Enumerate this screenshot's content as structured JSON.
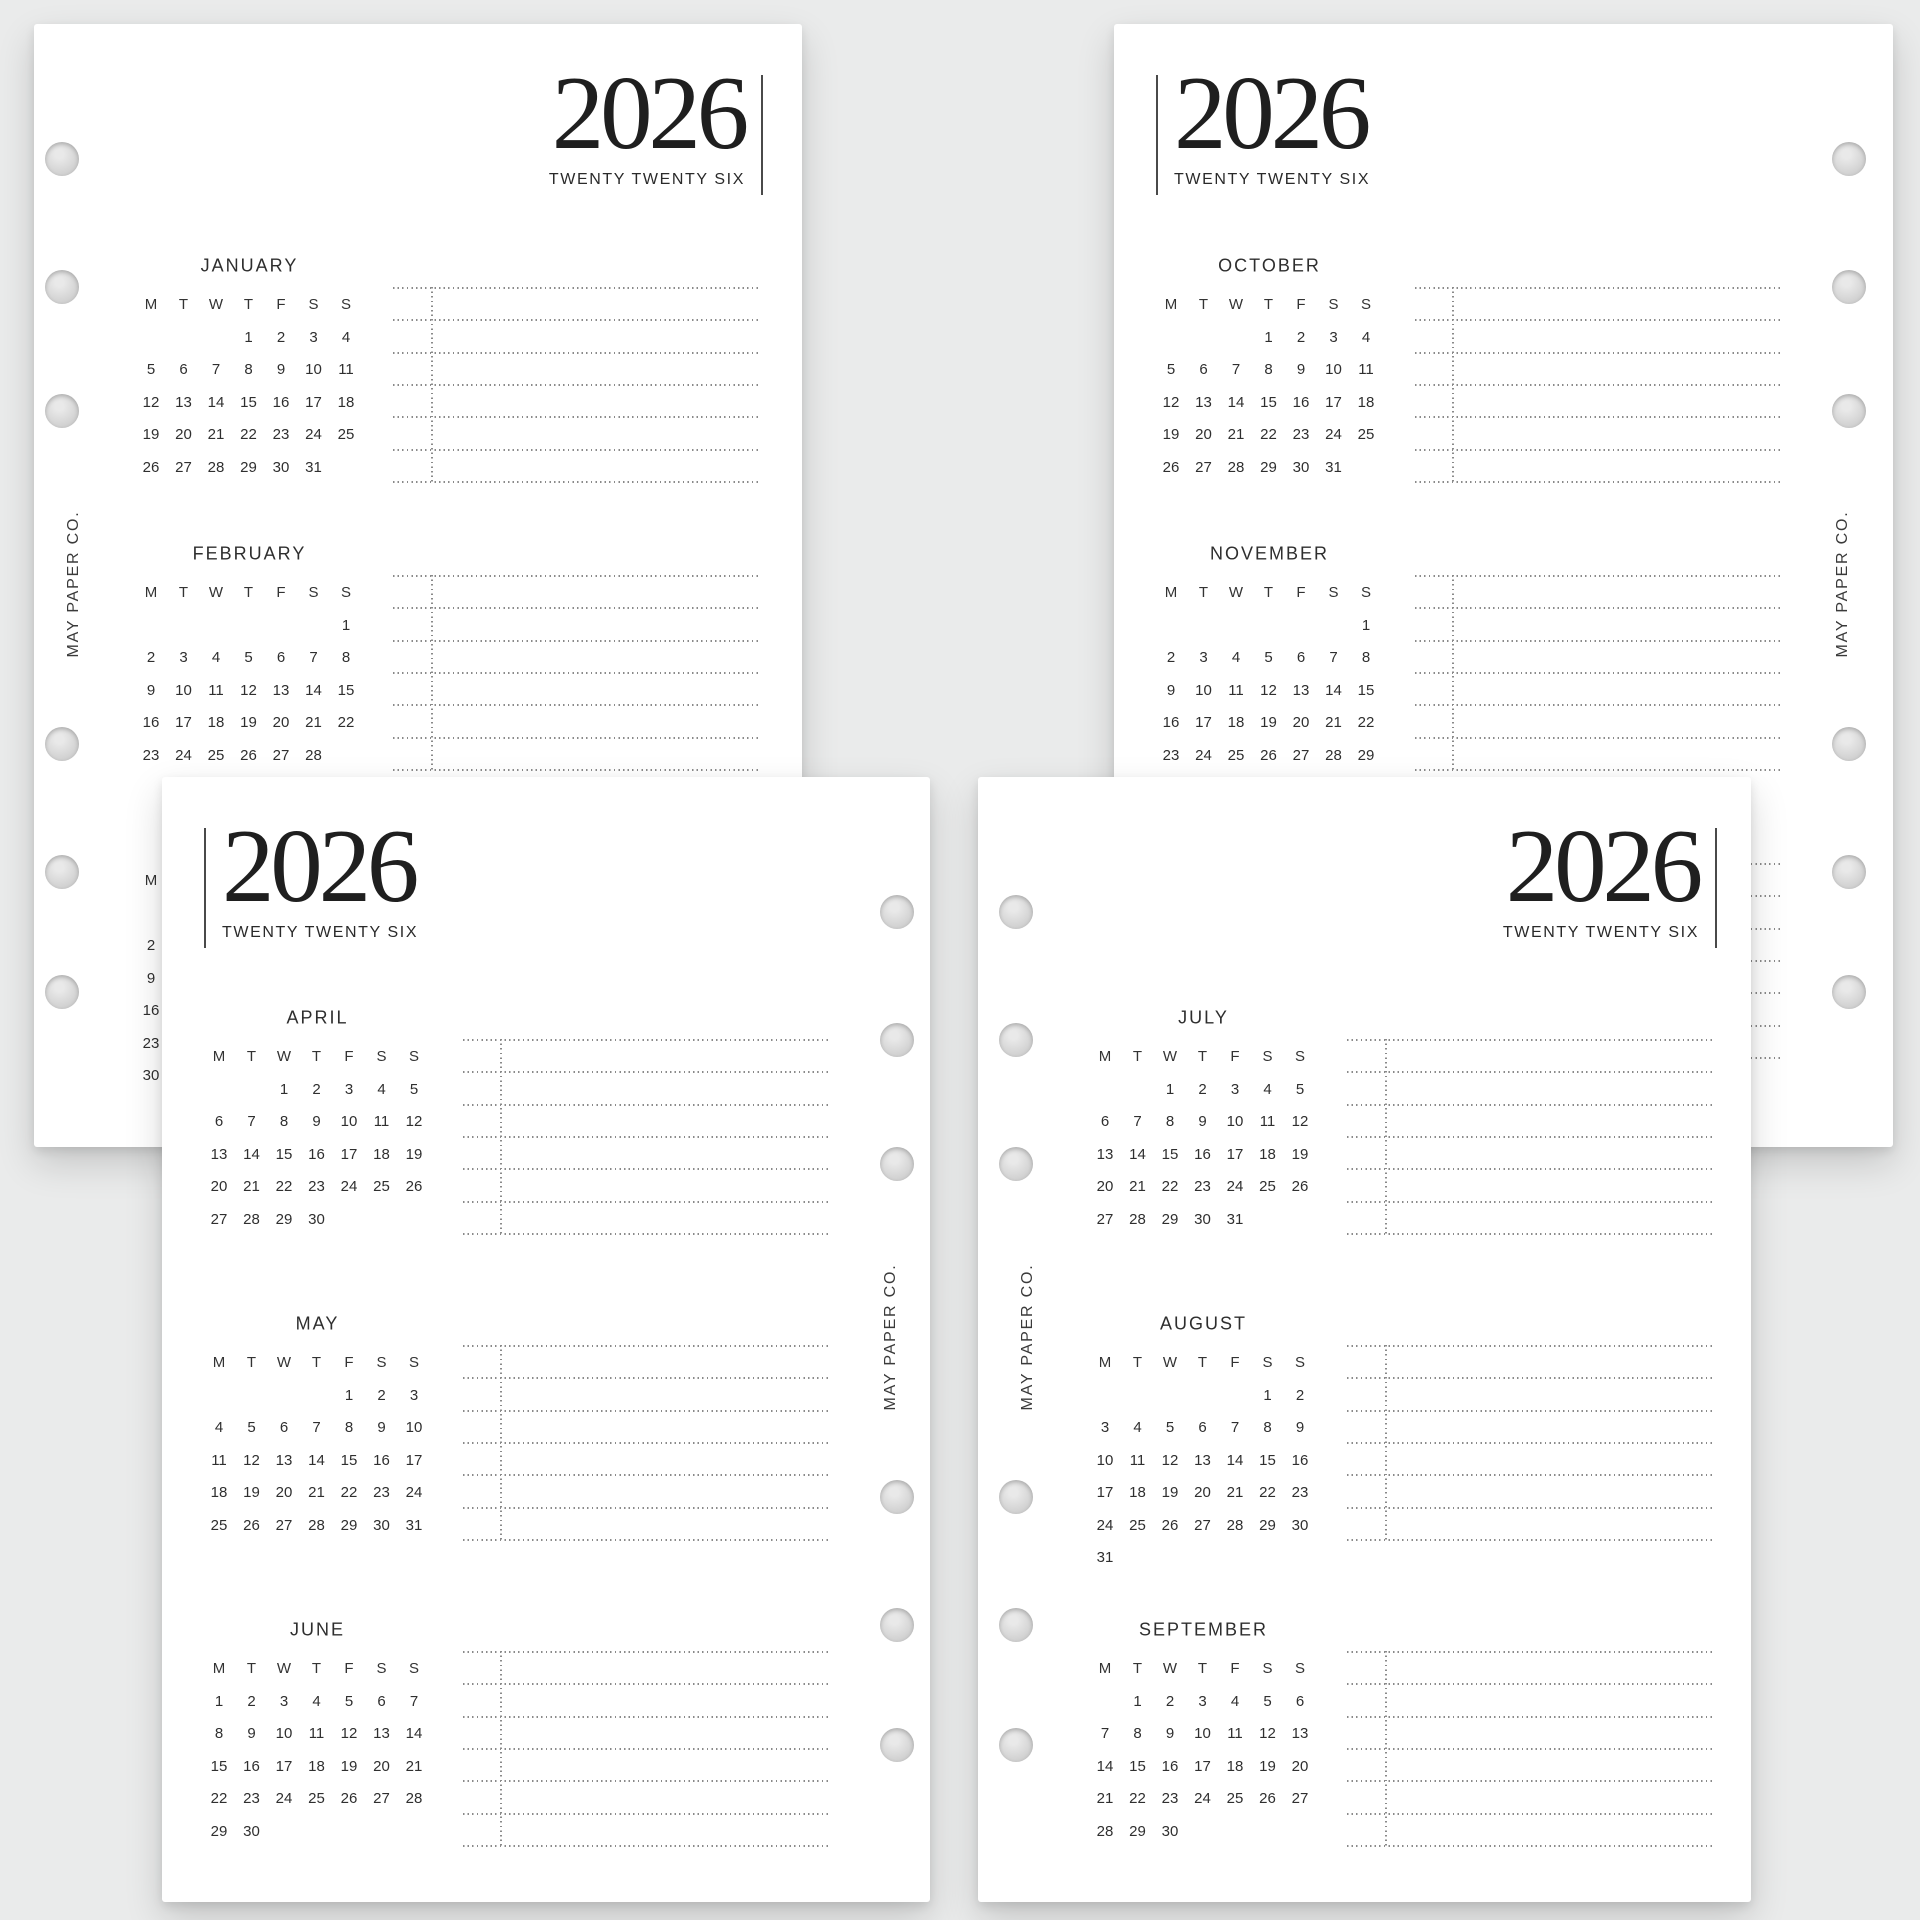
{
  "canvas": {
    "background": "#eaebeb"
  },
  "brand": {
    "label": "MAY PAPER CO."
  },
  "header": {
    "year": "2026",
    "subtitle": "TWENTY TWENTY SIX"
  },
  "weekdays": [
    "M",
    "T",
    "W",
    "T",
    "F",
    "S",
    "S"
  ],
  "colors": {
    "page": "#ffffff",
    "text": "#2e2e2e",
    "year_text": "#1f1f1f",
    "dotted_line": "#8a8a8a",
    "divider_bar": "#4a4a4a",
    "hole_fill": "#d6d6d6"
  },
  "months": {
    "JANUARY": {
      "name": "JANUARY",
      "weeks": [
        [
          "",
          "",
          "",
          "1",
          "2",
          "3",
          "4"
        ],
        [
          "5",
          "6",
          "7",
          "8",
          "9",
          "10",
          "11"
        ],
        [
          "12",
          "13",
          "14",
          "15",
          "16",
          "17",
          "18"
        ],
        [
          "19",
          "20",
          "21",
          "22",
          "23",
          "24",
          "25"
        ],
        [
          "26",
          "27",
          "28",
          "29",
          "30",
          "31",
          ""
        ]
      ]
    },
    "FEBRUARY": {
      "name": "FEBRUARY",
      "weeks": [
        [
          "",
          "",
          "",
          "",
          "",
          "",
          "1"
        ],
        [
          "2",
          "3",
          "4",
          "5",
          "6",
          "7",
          "8"
        ],
        [
          "9",
          "10",
          "11",
          "12",
          "13",
          "14",
          "15"
        ],
        [
          "16",
          "17",
          "18",
          "19",
          "20",
          "21",
          "22"
        ],
        [
          "23",
          "24",
          "25",
          "26",
          "27",
          "28",
          ""
        ]
      ]
    },
    "MARCH": {
      "name": "MARCH",
      "weeks": [
        [
          "",
          "",
          "",
          "",
          "",
          "",
          "1"
        ],
        [
          "2",
          "3",
          "4",
          "5",
          "6",
          "7",
          "8"
        ],
        [
          "9",
          "10",
          "11",
          "12",
          "13",
          "14",
          "15"
        ],
        [
          "16",
          "17",
          "18",
          "19",
          "20",
          "21",
          "22"
        ],
        [
          "23",
          "24",
          "25",
          "26",
          "27",
          "28",
          "29"
        ],
        [
          "30",
          "31",
          "",
          "",
          "",
          "",
          ""
        ]
      ]
    },
    "APRIL": {
      "name": "APRIL",
      "weeks": [
        [
          "",
          "",
          "1",
          "2",
          "3",
          "4",
          "5"
        ],
        [
          "6",
          "7",
          "8",
          "9",
          "10",
          "11",
          "12"
        ],
        [
          "13",
          "14",
          "15",
          "16",
          "17",
          "18",
          "19"
        ],
        [
          "20",
          "21",
          "22",
          "23",
          "24",
          "25",
          "26"
        ],
        [
          "27",
          "28",
          "29",
          "30",
          "",
          "",
          ""
        ]
      ]
    },
    "MAY": {
      "name": "MAY",
      "weeks": [
        [
          "",
          "",
          "",
          "",
          "1",
          "2",
          "3"
        ],
        [
          "4",
          "5",
          "6",
          "7",
          "8",
          "9",
          "10"
        ],
        [
          "11",
          "12",
          "13",
          "14",
          "15",
          "16",
          "17"
        ],
        [
          "18",
          "19",
          "20",
          "21",
          "22",
          "23",
          "24"
        ],
        [
          "25",
          "26",
          "27",
          "28",
          "29",
          "30",
          "31"
        ]
      ]
    },
    "JUNE": {
      "name": "JUNE",
      "weeks": [
        [
          "1",
          "2",
          "3",
          "4",
          "5",
          "6",
          "7"
        ],
        [
          "8",
          "9",
          "10",
          "11",
          "12",
          "13",
          "14"
        ],
        [
          "15",
          "16",
          "17",
          "18",
          "19",
          "20",
          "21"
        ],
        [
          "22",
          "23",
          "24",
          "25",
          "26",
          "27",
          "28"
        ],
        [
          "29",
          "30",
          "",
          "",
          "",
          "",
          ""
        ]
      ]
    },
    "JULY": {
      "name": "JULY",
      "weeks": [
        [
          "",
          "",
          "1",
          "2",
          "3",
          "4",
          "5"
        ],
        [
          "6",
          "7",
          "8",
          "9",
          "10",
          "11",
          "12"
        ],
        [
          "13",
          "14",
          "15",
          "16",
          "17",
          "18",
          "19"
        ],
        [
          "20",
          "21",
          "22",
          "23",
          "24",
          "25",
          "26"
        ],
        [
          "27",
          "28",
          "29",
          "30",
          "31",
          "",
          ""
        ]
      ]
    },
    "AUGUST": {
      "name": "AUGUST",
      "weeks": [
        [
          "",
          "",
          "",
          "",
          "",
          "1",
          "2"
        ],
        [
          "3",
          "4",
          "5",
          "6",
          "7",
          "8",
          "9"
        ],
        [
          "10",
          "11",
          "12",
          "13",
          "14",
          "15",
          "16"
        ],
        [
          "17",
          "18",
          "19",
          "20",
          "21",
          "22",
          "23"
        ],
        [
          "24",
          "25",
          "26",
          "27",
          "28",
          "29",
          "30"
        ],
        [
          "31",
          "",
          "",
          "",
          "",
          "",
          ""
        ]
      ]
    },
    "SEPTEMBER": {
      "name": "SEPTEMBER",
      "weeks": [
        [
          "",
          "1",
          "2",
          "3",
          "4",
          "5",
          "6"
        ],
        [
          "7",
          "8",
          "9",
          "10",
          "11",
          "12",
          "13"
        ],
        [
          "14",
          "15",
          "16",
          "17",
          "18",
          "19",
          "20"
        ],
        [
          "21",
          "22",
          "23",
          "24",
          "25",
          "26",
          "27"
        ],
        [
          "28",
          "29",
          "30",
          "",
          "",
          "",
          ""
        ]
      ]
    },
    "OCTOBER": {
      "name": "OCTOBER",
      "weeks": [
        [
          "",
          "",
          "",
          "1",
          "2",
          "3",
          "4"
        ],
        [
          "5",
          "6",
          "7",
          "8",
          "9",
          "10",
          "11"
        ],
        [
          "12",
          "13",
          "14",
          "15",
          "16",
          "17",
          "18"
        ],
        [
          "19",
          "20",
          "21",
          "22",
          "23",
          "24",
          "25"
        ],
        [
          "26",
          "27",
          "28",
          "29",
          "30",
          "31",
          ""
        ]
      ]
    },
    "NOVEMBER": {
      "name": "NOVEMBER",
      "weeks": [
        [
          "",
          "",
          "",
          "",
          "",
          "",
          "1"
        ],
        [
          "2",
          "3",
          "4",
          "5",
          "6",
          "7",
          "8"
        ],
        [
          "9",
          "10",
          "11",
          "12",
          "13",
          "14",
          "15"
        ],
        [
          "16",
          "17",
          "18",
          "19",
          "20",
          "21",
          "22"
        ],
        [
          "23",
          "24",
          "25",
          "26",
          "27",
          "28",
          "29"
        ],
        [
          "30",
          "",
          "",
          "",
          "",
          "",
          ""
        ]
      ]
    },
    "DECEMBER": {
      "name": "DECEMBER",
      "weeks": [
        [
          "",
          "1",
          "2",
          "3",
          "4",
          "5",
          "6"
        ],
        [
          "7",
          "8",
          "9",
          "10",
          "11",
          "12",
          "13"
        ],
        [
          "14",
          "15",
          "16",
          "17",
          "18",
          "19",
          "20"
        ],
        [
          "21",
          "22",
          "23",
          "24",
          "25",
          "26",
          "27"
        ],
        [
          "28",
          "29",
          "30",
          "31",
          "",
          "",
          ""
        ]
      ]
    }
  },
  "pages": [
    {
      "id": "top-left",
      "variant": "A",
      "holes_side": "left",
      "months": [
        "JANUARY",
        "FEBRUARY",
        "MARCH"
      ]
    },
    {
      "id": "top-right",
      "variant": "B",
      "holes_side": "right",
      "months": [
        "OCTOBER",
        "NOVEMBER",
        "DECEMBER"
      ]
    },
    {
      "id": "bottom-left",
      "variant": "B",
      "holes_side": "right",
      "months": [
        "APRIL",
        "MAY",
        "JUNE"
      ]
    },
    {
      "id": "bottom-right",
      "variant": "A",
      "holes_side": "left",
      "months": [
        "JULY",
        "AUGUST",
        "SEPTEMBER"
      ]
    }
  ]
}
